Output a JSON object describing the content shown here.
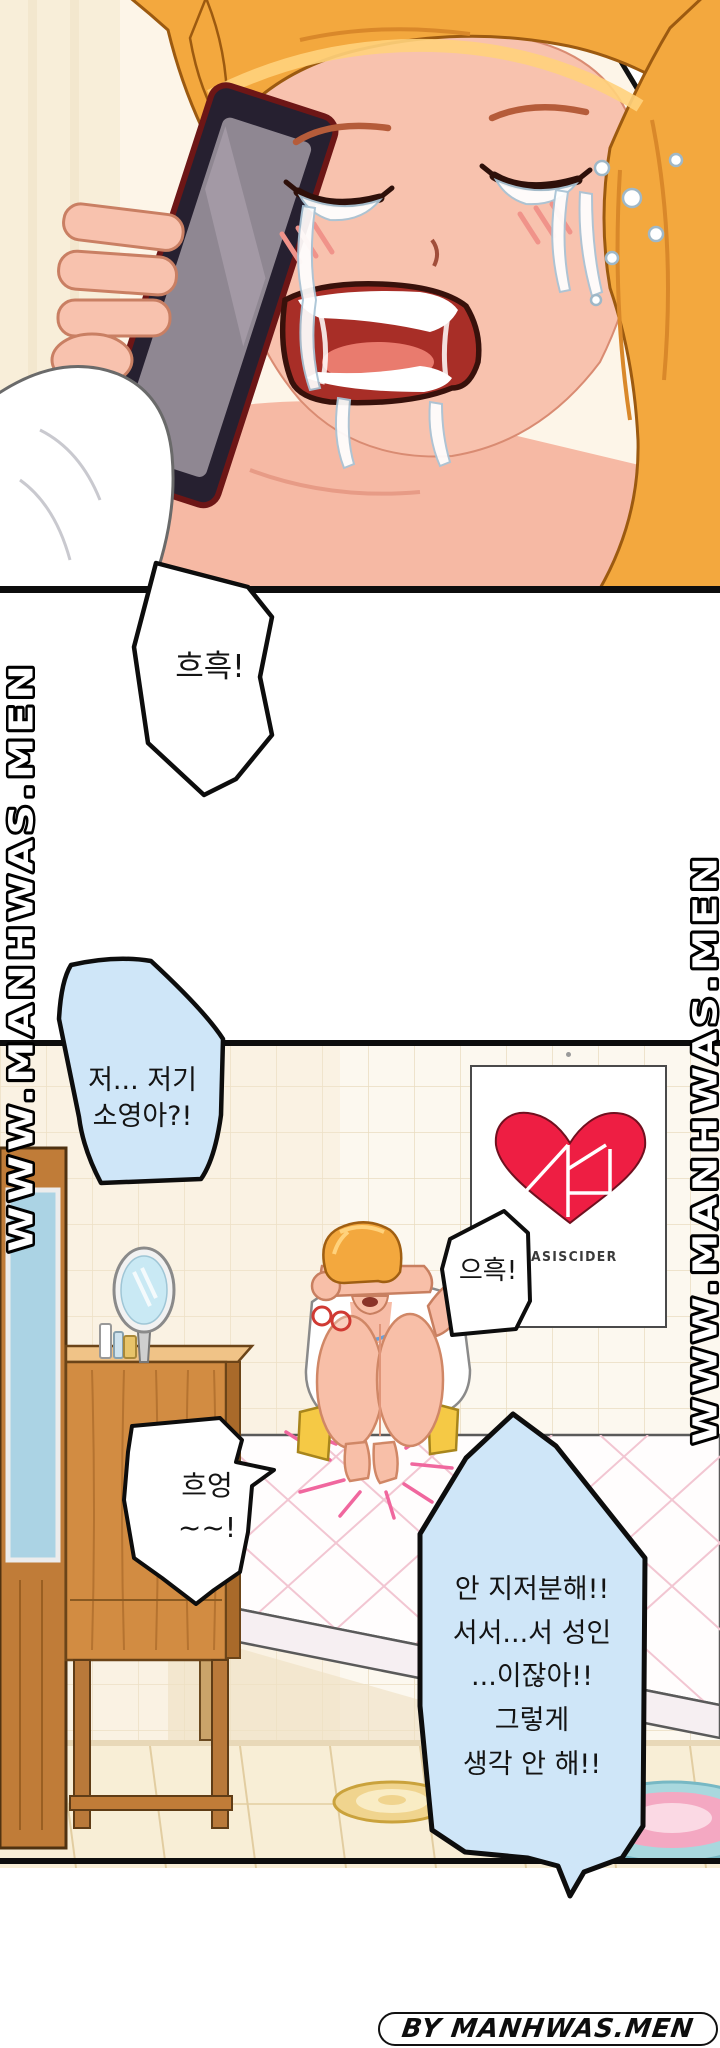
{
  "watermarks": {
    "left": "WWW.MANHWAS.MEN",
    "right": "WWW.MANHWAS.MEN"
  },
  "footer": {
    "credit": "BY MANHWAS.MEN"
  },
  "poster": {
    "brand": "OASISCIDER"
  },
  "bubbles": {
    "sob1": "흐흑!",
    "call_line1": "저... 저기",
    "call_line2": "소영아?!",
    "sob2": "으흑!",
    "cry_line1": "흐엉",
    "cry_line2": "~~!",
    "deny_line1": "안 지저분해!!",
    "deny_line2": "서서...서 성인",
    "deny_line3": "...이잖아!!",
    "deny_line4": "그렇게",
    "deny_line5": "생각 안 해!!"
  },
  "colors": {
    "bubble_blue": "#cfe6f8",
    "bubble_outline": "#0d0d0d",
    "heart_red": "#ee1e43",
    "hair_orange": "#f3a83e",
    "skin": "#f8c2ae",
    "wood": "#d28c42",
    "wall_tile": "#fcf8ef"
  }
}
